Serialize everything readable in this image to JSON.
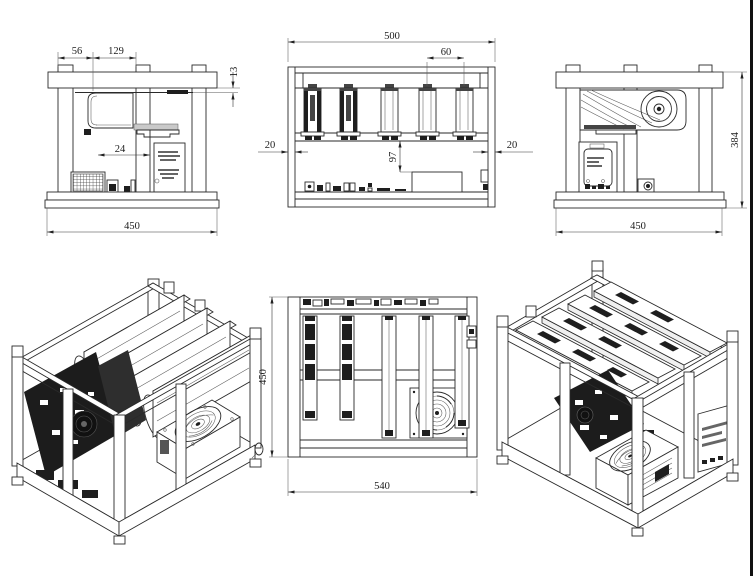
{
  "drawing": {
    "colors": {
      "line": "#2a2a2a",
      "background": "#ffffff",
      "border_right": "#111111"
    },
    "views": {
      "side_left": {
        "dims": {
          "d56": "56",
          "d129": "129",
          "d13": "13",
          "d24": "24",
          "d450": "450"
        }
      },
      "front": {
        "dims": {
          "d500": "500",
          "d60": "60",
          "d20_left": "20",
          "d20_right": "20",
          "d97": "97"
        }
      },
      "side_right": {
        "dims": {
          "d384": "384",
          "d450": "450"
        }
      },
      "plan": {
        "dims": {
          "d450": "450",
          "d540": "540"
        }
      }
    }
  }
}
